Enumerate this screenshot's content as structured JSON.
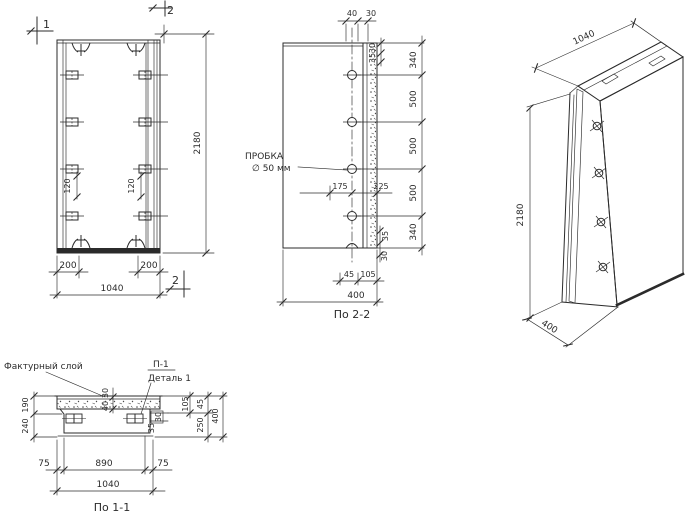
{
  "colors": {
    "ink": "#2b2b2b",
    "paper": "#ffffff"
  },
  "front_view": {
    "marker_1": "1",
    "marker_2_top": "2",
    "marker_2_bottom": "2",
    "dim_height": "2180",
    "dim_bracket_left": "120",
    "dim_bracket_right": "120",
    "dim_edge_left": "200",
    "dim_edge_right": "200",
    "dim_width": "1040"
  },
  "section_2_2": {
    "caption": "По 2-2",
    "dim_top_40": "40",
    "dim_top_30": "30",
    "dim_right_top_30": "30",
    "dim_right_top_35": "35",
    "segments": [
      "340",
      "500",
      "500",
      "500",
      "340"
    ],
    "plug_label_1": "ПРОБКА",
    "plug_label_2": "∅ 50 мм",
    "dim_mid_175": "175",
    "dim_mid_225": "225",
    "dim_right_bottom_35": "35",
    "dim_right_bottom_30": "30",
    "dim_bottom_45": "45",
    "dim_bottom_105": "105",
    "dim_depth": "400"
  },
  "iso_view": {
    "dim_width": "1040",
    "dim_height": "2180",
    "dim_depth": "400"
  },
  "section_1_1": {
    "caption": "По 1-1",
    "label_facing_layer": "Фактурный слой",
    "label_anchor": "П-1",
    "label_detail": "Деталь 1",
    "dim_layer_30": "30",
    "dim_layer_40": "40",
    "dim_left_190": "190",
    "dim_left_240": "240",
    "dim_right_105": "105",
    "dim_right_45": "45",
    "dim_right_400": "400",
    "dim_right_250": "250",
    "dim_detail_30": "30",
    "dim_detail_35": "35",
    "dim_bottom_75_left": "75",
    "dim_bottom_890": "890",
    "dim_bottom_75_right": "75",
    "dim_bottom_1040": "1040"
  }
}
